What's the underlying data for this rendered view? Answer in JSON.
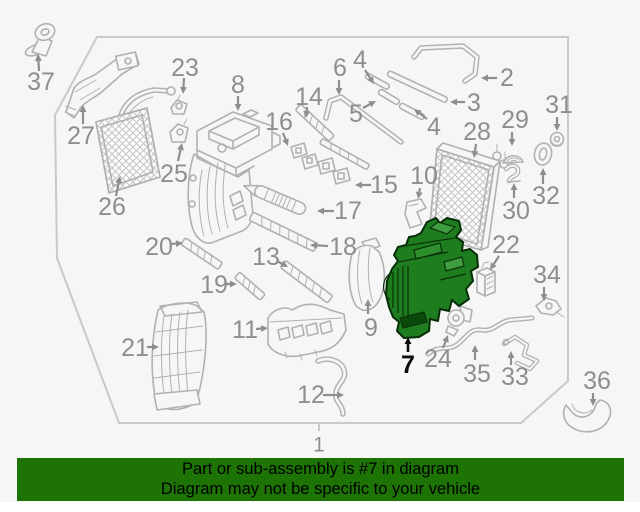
{
  "banner": {
    "line1": "Part or sub-assembly is #7 in diagram",
    "line2": "Diagram may not be specific to your vehicle"
  },
  "colors": {
    "banner_bg": "#1d7405",
    "banner_text": "#000000",
    "background": "#f6f6f6",
    "line": "#b1b1b1",
    "label": "#8e8e8e",
    "border": "#c9c9c9",
    "highlight_fill": "#1e7d1e",
    "highlight_light": "#3f9c3f",
    "highlight_dark": "#0c4a0c",
    "highlight_outline": "#072d07",
    "highlight_label": "#0b0b0b"
  },
  "highlighted_part": "7",
  "callouts": [
    {
      "n": "37",
      "x": 41,
      "y": 82,
      "a": [
        39,
        71,
        38,
        54
      ]
    },
    {
      "n": "27",
      "x": 81,
      "y": 136,
      "a": [
        83,
        124,
        83,
        105
      ]
    },
    {
      "n": "23",
      "x": 185,
      "y": 68,
      "a": [
        184,
        78,
        183,
        94
      ]
    },
    {
      "n": "25",
      "x": 174,
      "y": 174,
      "a": [
        178,
        161,
        182,
        143
      ]
    },
    {
      "n": "26",
      "x": 112,
      "y": 207,
      "a": [
        116,
        196,
        120,
        176
      ]
    },
    {
      "n": "8",
      "x": 238,
      "y": 85,
      "a": [
        238,
        96,
        238,
        111
      ]
    },
    {
      "n": "14",
      "x": 309,
      "y": 97,
      "a": [
        307,
        107,
        306,
        118
      ]
    },
    {
      "n": "16",
      "x": 279,
      "y": 122,
      "a": [
        283,
        133,
        288,
        146
      ]
    },
    {
      "n": "6",
      "x": 340,
      "y": 68,
      "a": [
        339,
        80,
        339,
        95
      ]
    },
    {
      "n": "4",
      "x": 360,
      "y": 60,
      "a": [
        365,
        70,
        374,
        84
      ]
    },
    {
      "n": "5",
      "x": 356,
      "y": 114,
      "a": [
        363,
        108,
        376,
        101
      ]
    },
    {
      "n": "2",
      "x": 507,
      "y": 78,
      "a": [
        497,
        78,
        481,
        78
      ]
    },
    {
      "n": "3",
      "x": 474,
      "y": 103,
      "a": [
        465,
        102,
        450,
        102
      ]
    },
    {
      "n": "4",
      "x": 434,
      "y": 127,
      "a": [
        427,
        119,
        414,
        109
      ]
    },
    {
      "n": "28",
      "x": 477,
      "y": 132,
      "a": [
        476,
        144,
        474,
        158
      ]
    },
    {
      "n": "29",
      "x": 515,
      "y": 120,
      "a": [
        512,
        132,
        512,
        146
      ]
    },
    {
      "n": "31",
      "x": 559,
      "y": 105,
      "a": [
        557,
        117,
        557,
        131
      ]
    },
    {
      "n": "32",
      "x": 546,
      "y": 196,
      "a": [
        543,
        184,
        543,
        168
      ]
    },
    {
      "n": "30",
      "x": 516,
      "y": 211,
      "a": [
        514,
        198,
        514,
        183
      ]
    },
    {
      "n": "10",
      "x": 424,
      "y": 176,
      "a": [
        420,
        188,
        418,
        199
      ]
    },
    {
      "n": "15",
      "x": 384,
      "y": 185,
      "a": [
        371,
        185,
        355,
        185
      ]
    },
    {
      "n": "17",
      "x": 348,
      "y": 211,
      "a": [
        334,
        211,
        317,
        211
      ]
    },
    {
      "n": "18",
      "x": 343,
      "y": 247,
      "a": [
        328,
        246,
        310,
        245
      ]
    },
    {
      "n": "13",
      "x": 266,
      "y": 257,
      "a": [
        277,
        261,
        288,
        267
      ]
    },
    {
      "n": "20",
      "x": 159,
      "y": 247,
      "a": [
        171,
        244,
        183,
        243
      ]
    },
    {
      "n": "19",
      "x": 214,
      "y": 285,
      "a": [
        226,
        284,
        237,
        284
      ]
    },
    {
      "n": "21",
      "x": 135,
      "y": 348,
      "a": [
        147,
        347,
        159,
        347
      ]
    },
    {
      "n": "11",
      "x": 245,
      "y": 330,
      "a": [
        256,
        329,
        268,
        328
      ]
    },
    {
      "n": "22",
      "x": 506,
      "y": 245,
      "a": [
        499,
        256,
        490,
        270
      ]
    },
    {
      "n": "9",
      "x": 371,
      "y": 328,
      "a": [
        368,
        314,
        368,
        299
      ]
    },
    {
      "n": "24",
      "x": 438,
      "y": 359,
      "a": [
        443,
        348,
        448,
        335
      ]
    },
    {
      "n": "35",
      "x": 477,
      "y": 374,
      "a": [
        475,
        360,
        475,
        345
      ]
    },
    {
      "n": "33",
      "x": 515,
      "y": 377,
      "a": [
        511,
        365,
        511,
        351
      ]
    },
    {
      "n": "34",
      "x": 547,
      "y": 275,
      "a": [
        544,
        287,
        544,
        301
      ]
    },
    {
      "n": "36",
      "x": 597,
      "y": 381,
      "a": [
        593,
        393,
        593,
        406
      ]
    },
    {
      "n": "12",
      "x": 311,
      "y": 395,
      "a": [
        323,
        395,
        344,
        395
      ]
    },
    {
      "n": "7",
      "x": 408,
      "y": 365,
      "a": [
        408,
        352,
        408,
        337
      ],
      "hl": true
    },
    {
      "n": "1",
      "x": 319,
      "y": 445,
      "s": 21
    }
  ]
}
